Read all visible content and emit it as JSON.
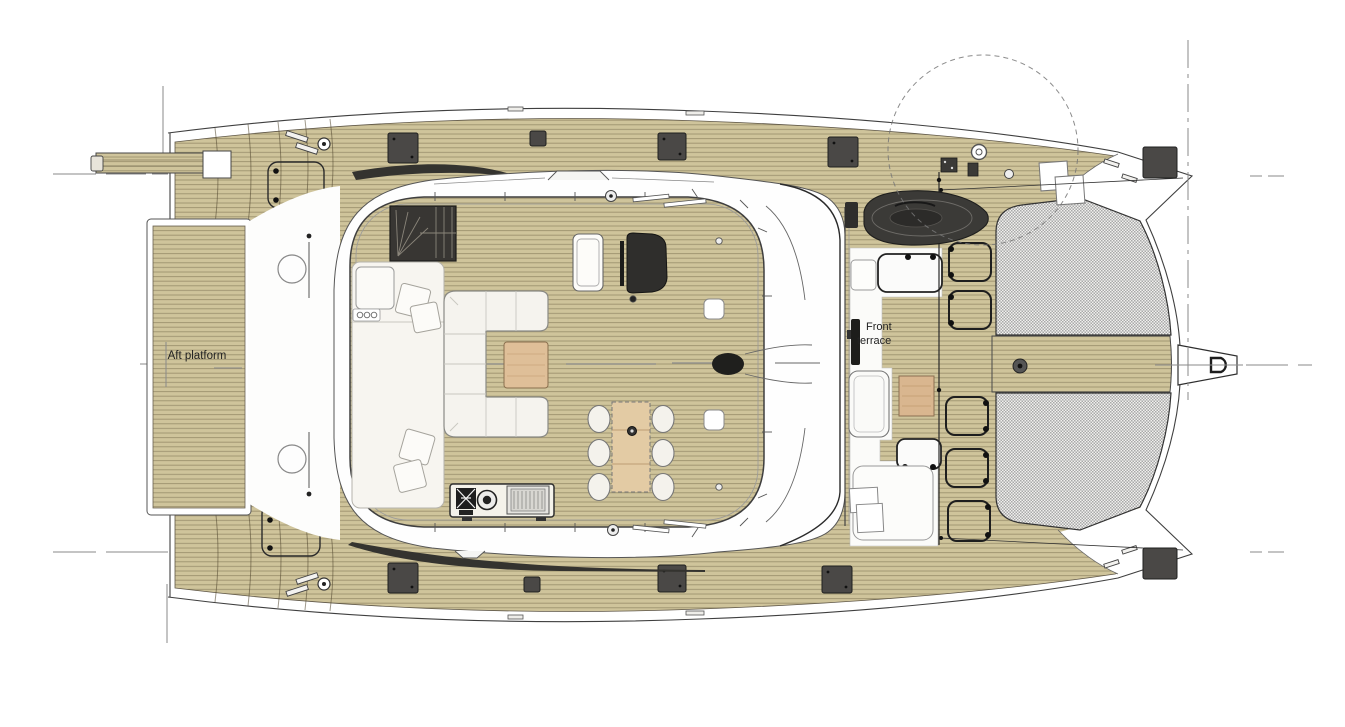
{
  "labels": {
    "aft_platform": "Aft platform",
    "front_terrace_line1": "Front",
    "front_terrace_line2": "terrace"
  },
  "colors": {
    "teak": "#cfc49b",
    "plank_line": "#6d624a",
    "hull_white": "#ffffff",
    "outline": "#3f3f3f",
    "dark_fixture": "#3b3a37",
    "shadow_band": "#34332f",
    "upholstery": "#f5f3ee",
    "wood_coffee_table": "#dfbf98",
    "wood_dining_table": "#e3cba4",
    "wood_side_table": "#d9b68f",
    "trampoline_base": "#f1f0ee",
    "trampoline_mesh": "#a8a8a8",
    "reference_line": "#8a8a8a",
    "label_text": "#222222"
  }
}
